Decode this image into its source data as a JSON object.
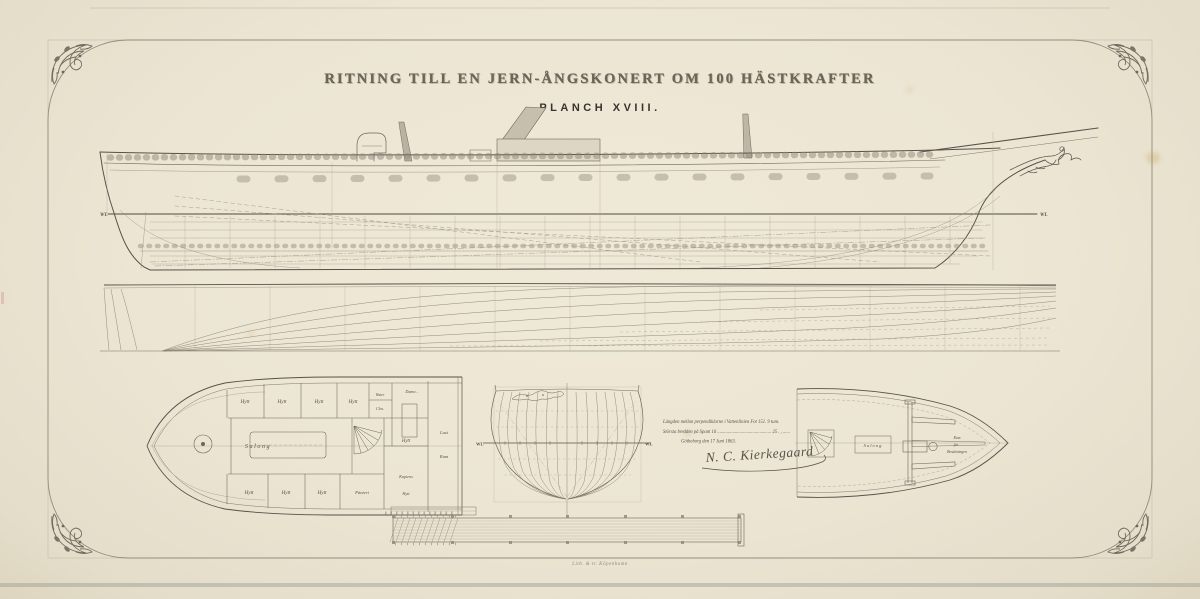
{
  "plate": {
    "title": "RITNING TILL EN JERN-ÅNGSKONERT OM 100 HÄSTKRAFTER",
    "subtitle": "PLANCH XVIII.",
    "printer_credit": "Lith. & tr. Köpenhamn"
  },
  "sheer_plan": {
    "wl_left": "WL",
    "wl_right": "WL"
  },
  "body_plan": {
    "wl_left": "WL",
    "wl_right": "WL"
  },
  "aft_deck_plan": {
    "hytt": "Hytt",
    "salong": "Salong",
    "water_line1": "Water",
    "water_line2": "Clos.",
    "dame": "Dame...",
    "last_line1": "Last",
    "last_line2": "Rum",
    "kaptens_line1": "Kaptens",
    "kaptens_line2": "Hytt",
    "panteri": "Pänteri"
  },
  "fore_deck_plan": {
    "salong": "Salong",
    "crew_line1": "Rum",
    "crew_line2": "för",
    "crew_line3": "Besättningen"
  },
  "notes": {
    "line1": "Längden mellan perpendiklarne i Vattenlinien   Fot 151. 9 tum.",
    "line2": "Största bredden på Spant 16 ..............................................  25 . ,  ......",
    "line3": "Götheborg den 17 Juni 1863.",
    "signature": "N. C. Kierkegaard"
  },
  "colors": {
    "paper": "#ece5d3",
    "ink": "#56524a",
    "ink_light": "#9a9484",
    "frame": "#928b7a"
  }
}
